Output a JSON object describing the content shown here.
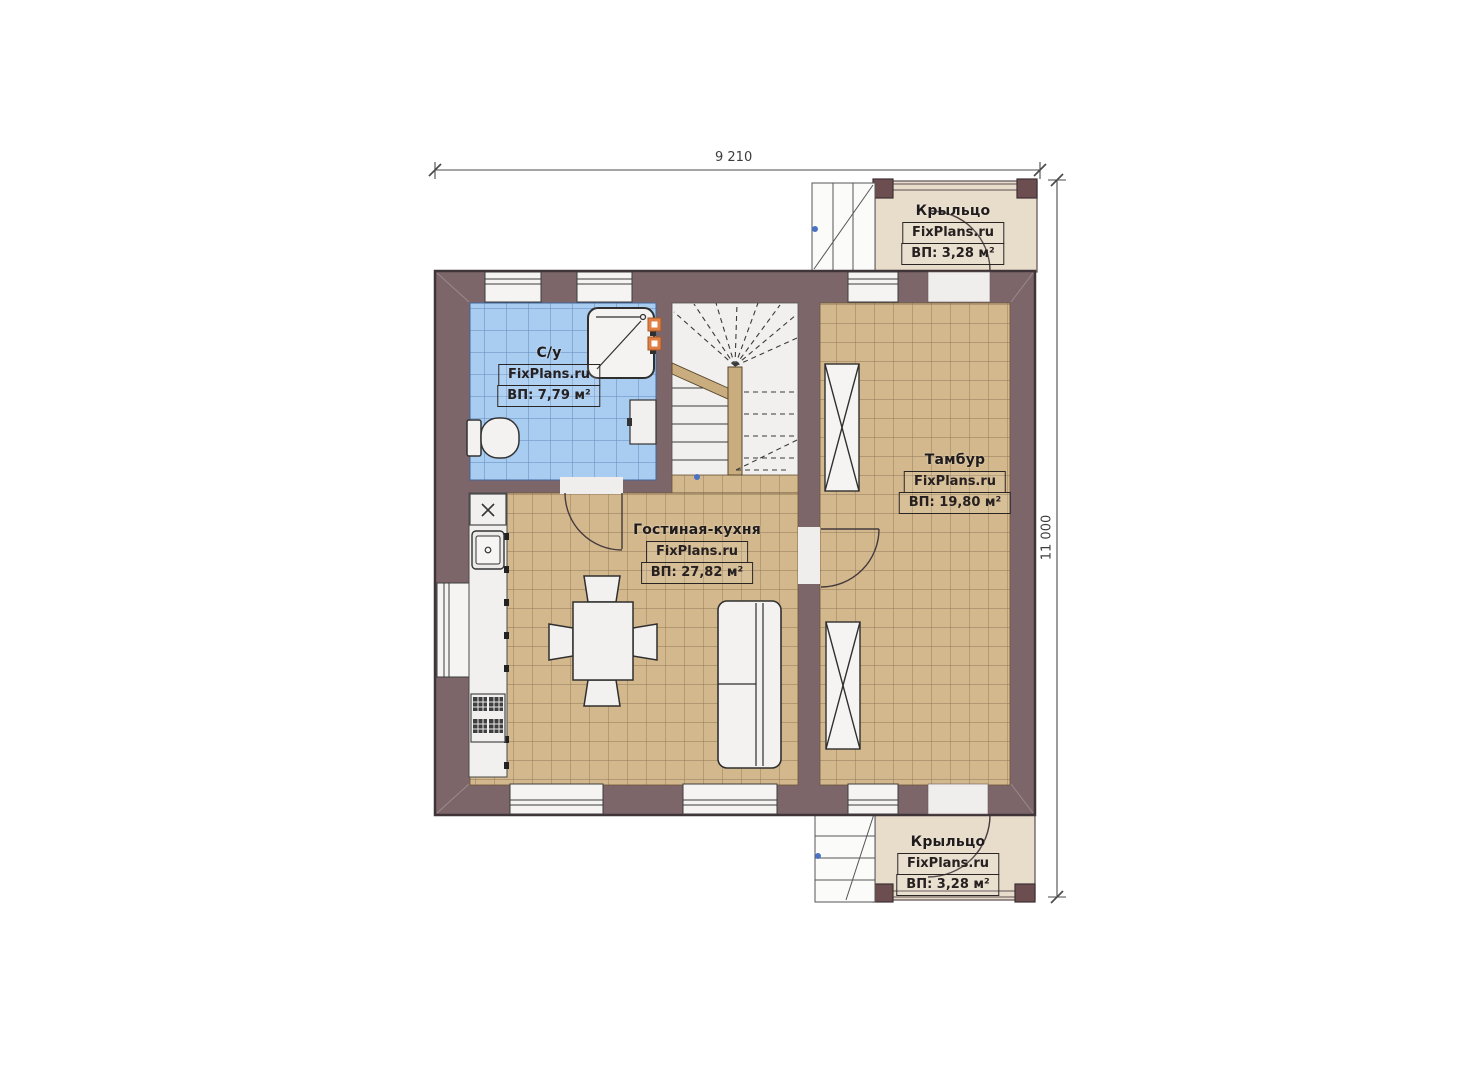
{
  "watermark": "FixPlans.ru",
  "dimensions": {
    "width_top": "9 210",
    "height_right": "11 000"
  },
  "rooms": {
    "porch_top": {
      "name": "Крыльцо",
      "area": "ВП: 3,28 м²"
    },
    "bathroom": {
      "name": "С/у",
      "area": "ВП: 7,79 м²"
    },
    "vestibule": {
      "name": "Тамбур",
      "area": "ВП: 19,80 м²"
    },
    "living_kitchen": {
      "name": "Гостиная-кухня",
      "area": "ВП: 27,82 м²"
    },
    "porch_bottom": {
      "name": "Крыльцо",
      "area": "ВП: 3,28 м²"
    }
  },
  "colors": {
    "wall": "#7c666a",
    "wall_outline": "#3f3438",
    "tan_tile": "#d3b88d",
    "tan_grid": "#8f7857",
    "blue_tile": "#a9ccf1",
    "blue_grid": "#6289ba",
    "porch_floor": "#e8ddcb",
    "porch_post": "#6d4e50",
    "stair_wood": "#c9ad7e",
    "vent_orange": "#e08044",
    "fixture_white": "#f2f1ef",
    "marker_blue": "#4a72c4"
  }
}
